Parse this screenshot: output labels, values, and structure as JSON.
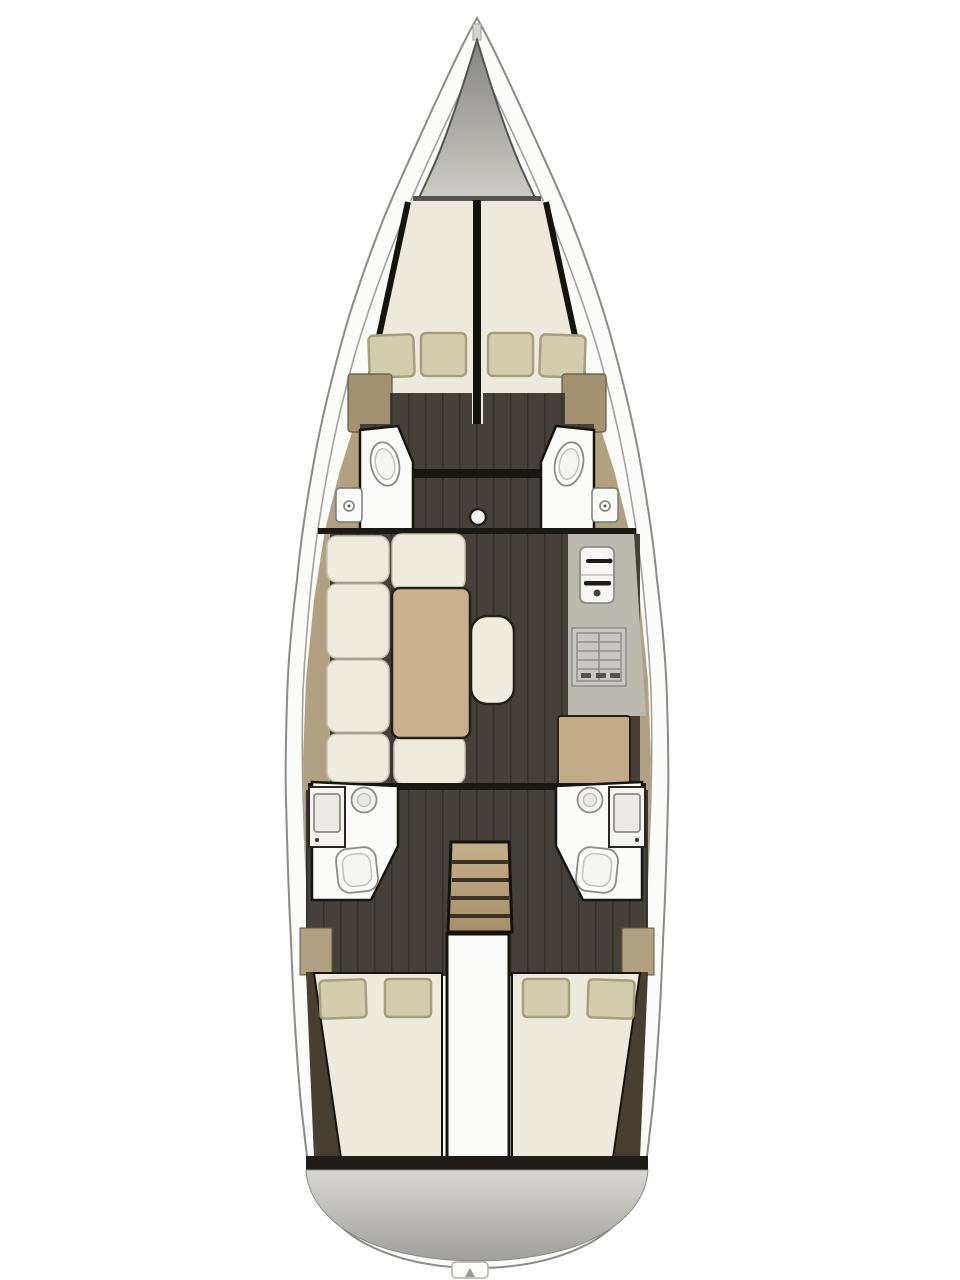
{
  "diagram": {
    "type": "sailing-yacht-interior-floor-plan",
    "view": "top-down",
    "orientation": "bow-up",
    "forward_cabins": 2,
    "aft_cabins": 2,
    "heads_compartments": 4,
    "toilets": 4,
    "showers": 2,
    "wash_basins": 5,
    "salon_sofa_cushions": 7,
    "salon_tables": 1,
    "center_bench": 1,
    "galley_stove": 1,
    "galley_sink": 1,
    "chart_table": 1,
    "companionway_steps": 4,
    "pillows_forward": 4,
    "pillows_aft": 4,
    "mast_base": 1,
    "swim_platform": 1,
    "stern_ladder_tab": 1
  },
  "colors": {
    "page_bg": "#ffffff",
    "hull_band": "#fbfbf9",
    "hull_line": "#8d8b87",
    "deck_inner_line": "#a3a19c",
    "interior_tan": "#b2a181",
    "wardrobe_tan": "#a3926f",
    "floor_dark": "#45413a",
    "floor_seam": "#34302a",
    "berth_cream": "#edeadd",
    "cushion_cream": "#eeebde",
    "bench_cream": "#efecdf",
    "pillow_khaki": "#d2cdaa",
    "pillow_border": "#a59f7e",
    "fixture_white": "#fbfbf9",
    "outline_dark": "#17150f",
    "bulkhead_dark": "#1b1914",
    "wood_table": "#c9b18d",
    "wood_desk": "#c4ab88",
    "counter_gray": "#bcb9b1",
    "stove_gray": "#c7c6c2",
    "wedge_brown": "#473f31",
    "locker_dark": "#85837f",
    "locker_light": "#cfcdc8",
    "transom_light": "#d9d7d3",
    "transom_dark": "#a09e9a",
    "panel_white": "#fbfbf9",
    "toilet_white": "#fcfcfa",
    "shower_gray": "#f2f2ef"
  }
}
